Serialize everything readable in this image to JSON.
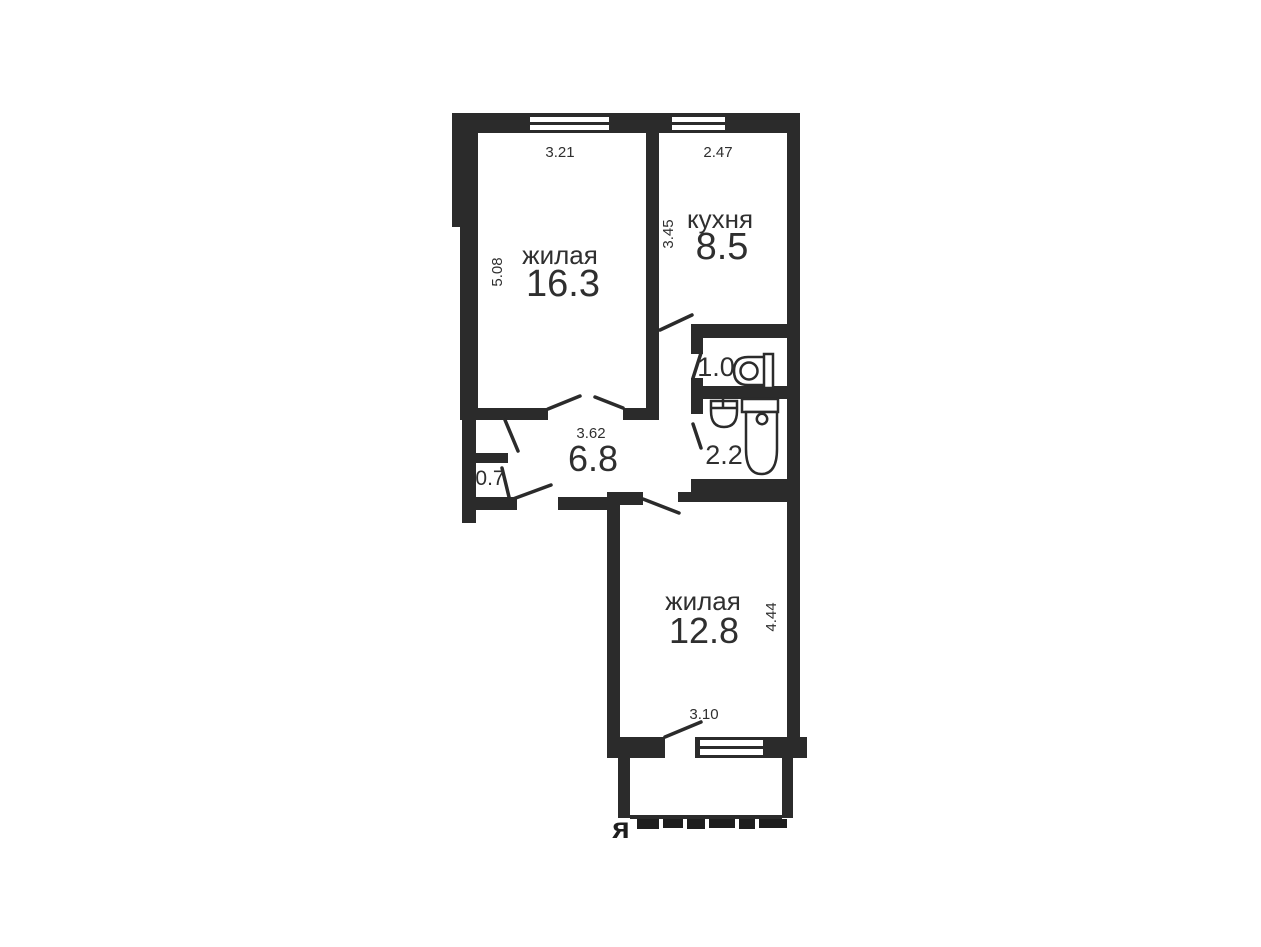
{
  "plan": {
    "colors": {
      "wall": "#2b2b2b",
      "text": "#2f2f2f",
      "background": "#ffffff"
    },
    "rooms": {
      "living1": {
        "label": "жилая",
        "area": "16.3",
        "dim_top": "3.21",
        "dim_side": "5.08"
      },
      "kitchen": {
        "label": "кухня",
        "area": "8.5",
        "dim_top": "2.47",
        "dim_side": "3.45"
      },
      "wc": {
        "area": "1.0"
      },
      "bathroom": {
        "area": "2.2"
      },
      "hallway": {
        "area": "6.8",
        "dim_top": "3.62"
      },
      "closet": {
        "area": "0.7"
      },
      "living2": {
        "label": "жилая",
        "area": "12.8",
        "dim_side": "4.44",
        "dim_bottom": "3.10"
      }
    },
    "fixtures": [
      "water-heater-icon",
      "sink-icon",
      "toilet-icon"
    ],
    "watermark": {
      "visible_letter": "я"
    }
  }
}
